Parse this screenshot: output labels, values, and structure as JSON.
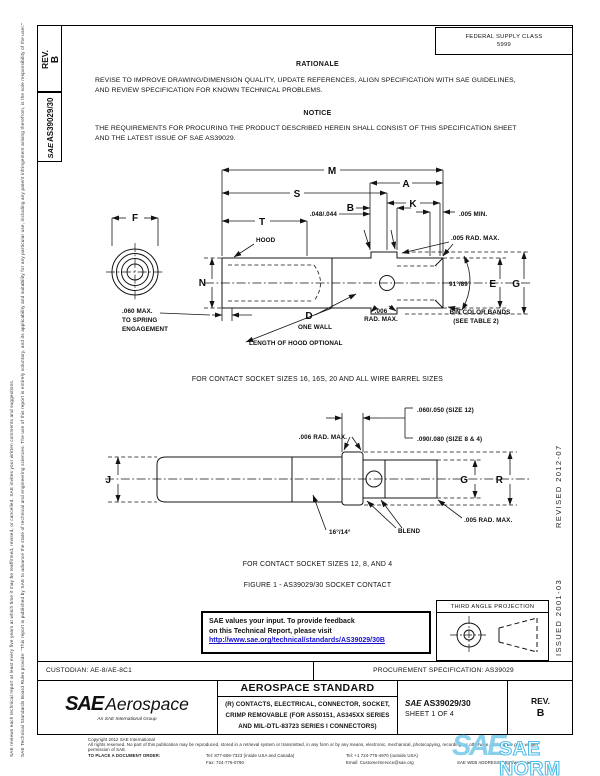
{
  "page": {
    "margin_note_rules": "SAE Technical Standards Board Rules provide: “This report is published by SAE to advance the state of technical and engineering sciences. The use of this report is entirely voluntary, and its applicability and suitability for any particular use, including any patent infringement arising therefrom, is the sole responsibility of the user.”",
    "margin_note_review": "SAE reviews each technical report at least every five years at which time it may be reaffirmed, revised, or cancelled. SAE invites your written comments and suggestions.",
    "rev_label": "REV.",
    "rev_value": "B",
    "doc_logo": "SAE",
    "doc_number": "AS39029/30",
    "fsc_label": "FEDERAL SUPPLY CLASS",
    "fsc_value": "5999",
    "revised_mark": "REVISED 2012-07",
    "issued_mark": "ISSUED 2001-03"
  },
  "rationale": {
    "heading": "RATIONALE",
    "body": "REVISE TO IMPROVE DRAWING/DIMENSION QUALITY, UPDATE REFERENCES, ALIGN SPECIFICATION WITH SAE GUIDELINES, AND REVIEW SPECIFICATION FOR KNOWN TECHNICAL PROBLEMS."
  },
  "notice": {
    "heading": "NOTICE",
    "body": "THE REQUIREMENTS FOR PROCURING THE PRODUCT DESCRIBED HEREIN SHALL CONSIST OF THIS SPECIFICATION SHEET AND THE LATEST ISSUE OF SAE AS39029."
  },
  "fig1": {
    "dims": {
      "M": "M",
      "A": "A",
      "S": "S",
      "K": "K",
      "B": "B",
      "T": "T",
      "F": "F",
      "N": "N",
      "E": "E",
      "G": "G",
      "D": "D"
    },
    "notes": {
      "tol_048": ".048/.044",
      "min_005": ".005 MIN.",
      "hood": "HOOD",
      "rad_005": ".005 RAD. MAX.",
      "angle": "91°/89°",
      "spring_1": ".060 MAX.",
      "spring_2": "TO SPRING",
      "spring_3": "ENGAGEMENT",
      "one_wall": "ONE WALL",
      "rad_006_1": ".006",
      "rad_006_2": "RAD. MAX.",
      "bin_1": "BIN COLOR BANDS",
      "bin_2": "(SEE TABLE 2)",
      "hood_optional": "LENGTH OF HOOD OPTIONAL"
    },
    "caption": "FOR CONTACT SOCKET SIZES 16, 16S, 20 AND ALL WIRE BARREL SIZES"
  },
  "fig2": {
    "dims": {
      "J": "J",
      "G": "G",
      "R": "R"
    },
    "notes": {
      "size_12": ".060/.050 (SIZE 12)",
      "size_8_4": ".090/.080 (SIZE 8 & 4)",
      "rad_006": ".006 RAD. MAX.",
      "angle": "16°/14°",
      "blend": "BLEND",
      "rad_005": ".005 RAD. MAX."
    },
    "caption": "FOR CONTACT SOCKET SIZES 12, 8, AND 4",
    "figure_caption": "FIGURE 1 - AS39029/30 SOCKET CONTACT"
  },
  "feedback": {
    "line1": "SAE values your input. To provide feedback",
    "line2": "on this Technical Report, please visit",
    "link": "http://www.sae.org/technical/standards/AS39029/30B"
  },
  "projection": {
    "label": "THIRD ANGLE PROJECTION"
  },
  "admin": {
    "custodian": "CUSTODIAN: AE-8/AE-8C1",
    "procurement": "PROCUREMENT SPECIFICATION: AS39029"
  },
  "title_block": {
    "logo_sae": "SAE",
    "logo_aerospace": "Aerospace",
    "logo_tagline": "An SAE International Group",
    "standard_type": "AEROSPACE STANDARD",
    "title_line1": "(R) CONTACTS, ELECTRICAL, CONNECTOR, SOCKET,",
    "title_line2": "CRIMP REMOVABLE (FOR AS50151, AS345XX SERIES",
    "title_line3": "AND MIL-DTL-83723 SERIES I CONNECTORS)",
    "doc_logo": "SAE",
    "doc_number": "AS39029/30",
    "sheet": "SHEET 1 OF 4",
    "rev_label": "REV.",
    "rev_value": "B"
  },
  "footer": {
    "copyright": "Copyright 2012 SAE International",
    "rights": "All rights reserved. No part of this publication may be reproduced, stored in a retrieval system or transmitted, in any form or by any means, electronic, mechanical, photocopying, recording, or otherwise, without the prior written permission of SAE.",
    "order_label": "TO PLACE A DOCUMENT ORDER:",
    "tel_inside": "Tel: 877-606-7323 (inside USA and Canada)",
    "tel_outside": "Tel: +1 724-776-4970 (outside USA)",
    "fax": "Fax: 724-776-0790",
    "email": "Email: CustomerService@sae.org",
    "web": "SAE WEB ADDRESS: http://www.sae.org"
  },
  "watermark": {
    "sae": "SAE",
    "norm": "SAE NORM",
    "left_tag": "INTERNATIONAL",
    "right_tag": "STANDARDS",
    "color": "#45b9e8"
  }
}
